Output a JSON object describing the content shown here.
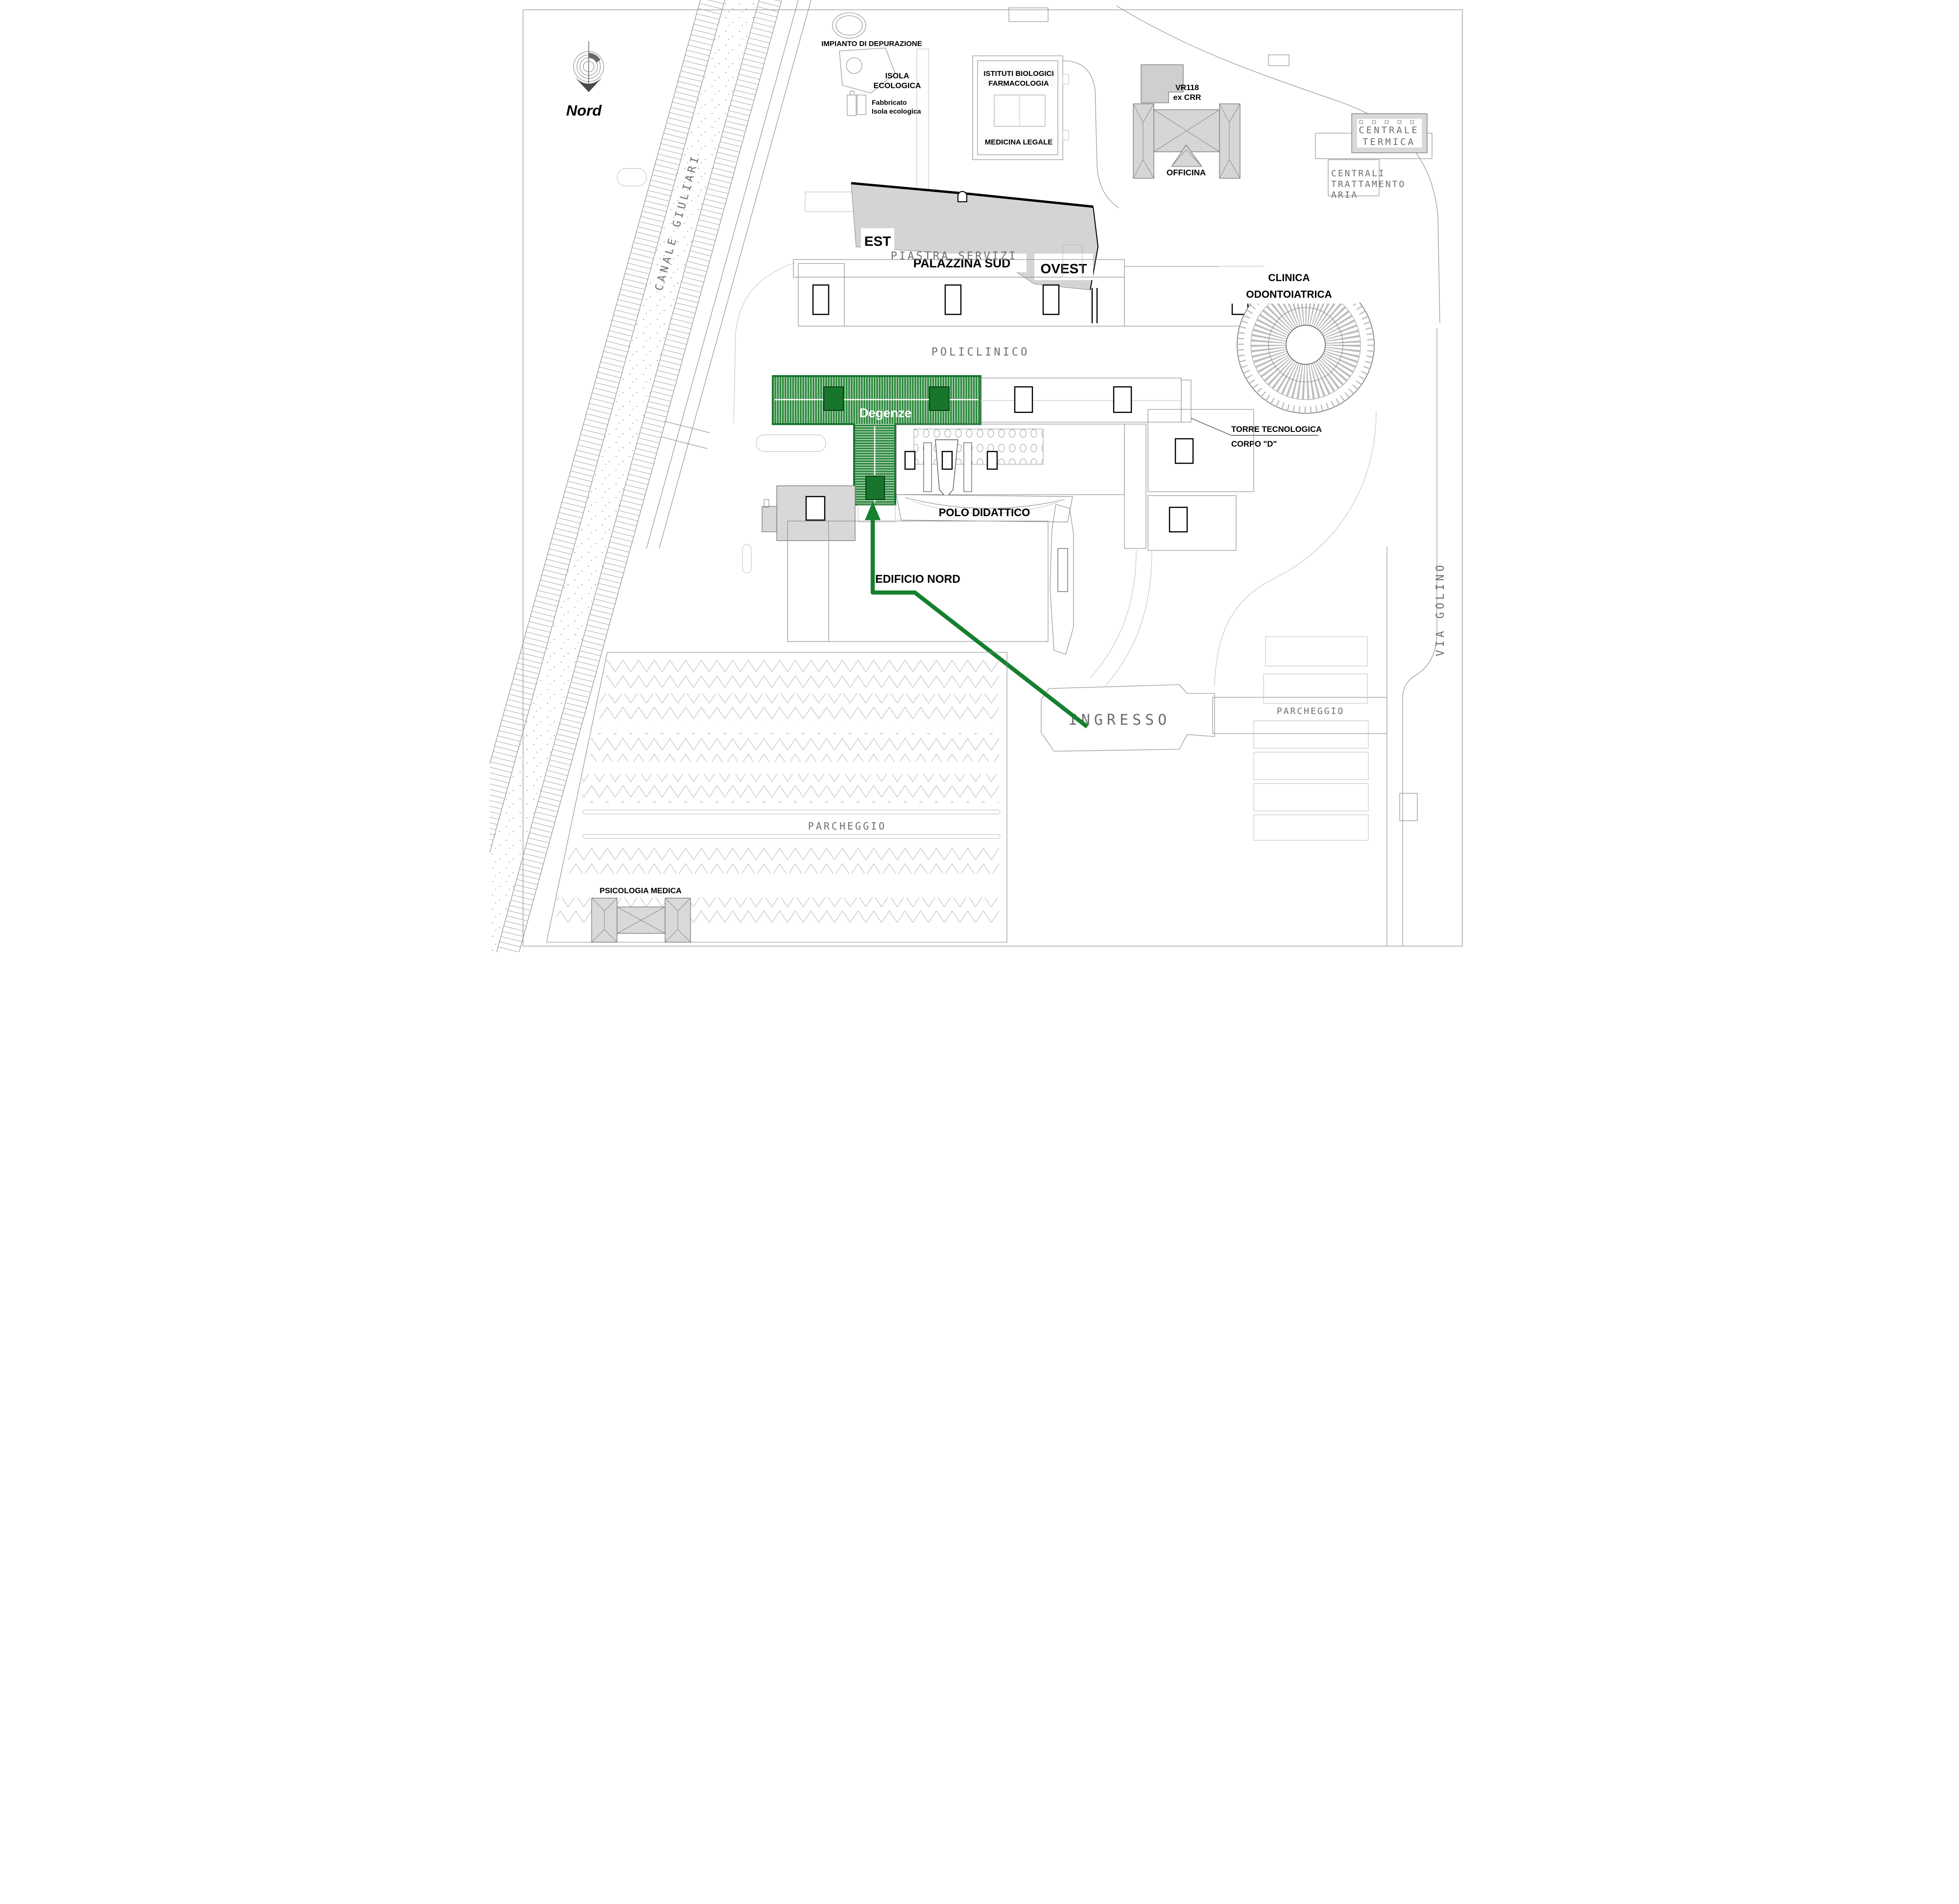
{
  "compass": {
    "north_label": "Nord"
  },
  "labels": {
    "impianto_depurazione": "IMPIANTO DI DEPURAZIONE",
    "isola_ecologica_1": "ISOLA",
    "isola_ecologica_2": "ECOLOGICA",
    "fabbricato_1": "Fabbricato",
    "fabbricato_2": "Isola ecologica",
    "istituti_biologici": "ISTITUTI BIOLOGICI",
    "farmacologia": "FARMACOLOGIA",
    "medicina_legale": "MEDICINA LEGALE",
    "vr118_1": "VR118",
    "vr118_2": "ex CRR",
    "officina": "OFFICINA",
    "centrale_termica_1": "CENTRALE",
    "centrale_termica_2": "TERMICA",
    "centrali_aria_1": "CENTRALI",
    "centrali_aria_2": "TRATTAMENTO",
    "centrali_aria_3": "ARIA",
    "est": "EST",
    "palazzina_sud": "PALAZZINA SUD",
    "ovest": "OVEST",
    "piastra_servizi": "PIASTRA SERVIZI",
    "clinica_1": "CLINICA",
    "clinica_2": "ODONTOIATRICA",
    "policlinico": "POLICLINICO",
    "degenze": "Degenze",
    "torre_tecnologica_1": "TORRE TECNOLOGICA",
    "torre_tecnologica_2": "CORPO \"D\"",
    "polo_didattico": "POLO DIDATTICO",
    "edificio_nord": "EDIFICIO NORD",
    "ingresso": "INGRESSO",
    "parcheggio_left": "PARCHEGGIO",
    "parcheggio_right": "PARCHEGGIO",
    "psicologia_medica": "PSICOLOGIA MEDICA",
    "canale_giuliari": "CANALE GIULIARI",
    "via_golino": "VIA GOLINO"
  },
  "colors": {
    "highlight_green": "#2e8b3f",
    "highlight_green_dark": "#17762c",
    "route_green": "#157f2e",
    "building_gray": "#d6d6d6",
    "cad_text_gray": "#6e6e6e",
    "line_gray": "#8a8a8a"
  }
}
